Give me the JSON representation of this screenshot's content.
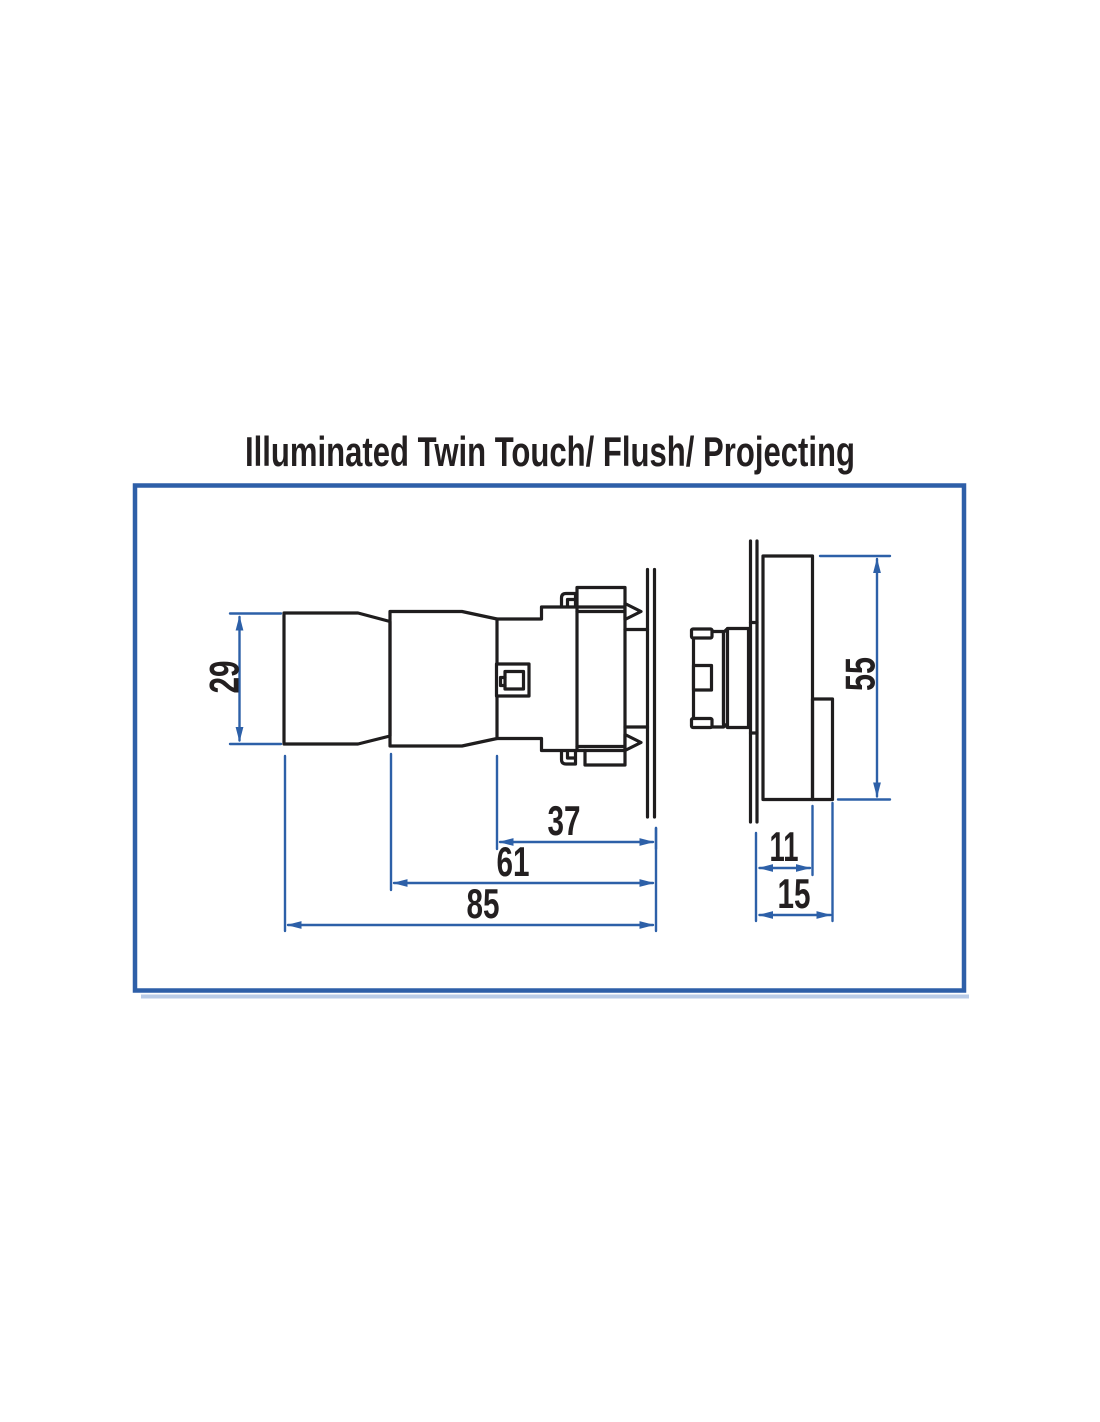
{
  "title": "Illuminated Twin Touch/ Flush/ Projecting",
  "diagram": {
    "type": "engineering-dimension-drawing",
    "dimensions": {
      "button_height": "29",
      "rear_unit_height": "55",
      "body_depth": "37",
      "guard_depth": "61",
      "overall_length": "85",
      "rear_body_depth": "11",
      "rear_overall_depth": "15"
    },
    "colors": {
      "outline": "#1f1d1e",
      "dimension_line": "#2d60a8",
      "frame_border": "#2e5fa8",
      "frame_shadow": "#b9cbe7",
      "text": "#231f20"
    }
  }
}
